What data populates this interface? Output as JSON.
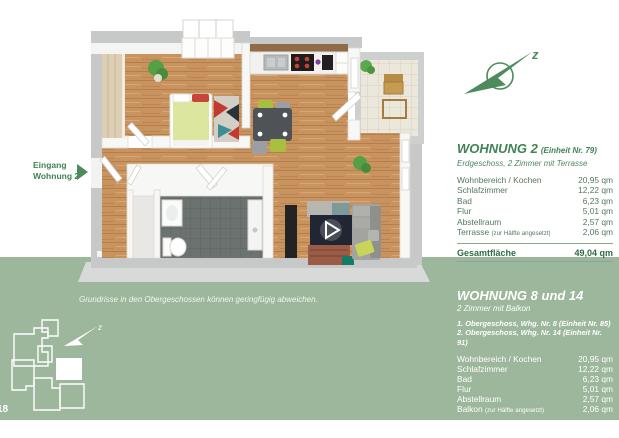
{
  "colors": {
    "brand_green": "#3f8354",
    "band_green": "#9cb79b",
    "row_green": "#53795f",
    "total_green": "#2e6a44"
  },
  "page_number": "18",
  "plan_annotations": {
    "entrance_label": "Eingang Wohnung 2",
    "compass_letter": "z"
  },
  "footer": {
    "disclaimer": "Grundrisse in den Obergeschossen können geringfügig abweichen."
  },
  "apartment_top": {
    "title": "WOHNUNG 2",
    "title_note": "(Einheit Nr. 79)",
    "subtitle": "Erdgeschoss, 2 Zimmer mit Terrasse",
    "rows": [
      {
        "label": "Wohnbereich / Kochen",
        "value": "20,95 qm"
      },
      {
        "label": "Schlafzimmer",
        "value": "12,22 qm"
      },
      {
        "label": "Bad",
        "value": "6,23 qm"
      },
      {
        "label": "Flur",
        "value": "5,01 qm"
      },
      {
        "label": "Abstellraum",
        "value": "2,57 qm"
      },
      {
        "label": "Terrasse",
        "note": "(zur Hälfte angesetzt)",
        "value": "2,06 qm"
      }
    ],
    "total_label": "Gesamtfläche",
    "total_value": "49,04 qm"
  },
  "apartment_bottom": {
    "title": "WOHNUNG 8 und 14",
    "subtitle": "2 Zimmer mit Balkon",
    "floor_notes": [
      "1. Obergeschoss, Whg. Nr. 8 (Einheit Nr. 85)",
      "2. Obergeschoss, Whg. Nr. 14 (Einheit Nr. 91)"
    ],
    "rows": [
      {
        "label": "Wohnbereich / Kochen",
        "value": "20,95 qm"
      },
      {
        "label": "Schlafzimmer",
        "value": "12,22 qm"
      },
      {
        "label": "Bad",
        "value": "6,23 qm"
      },
      {
        "label": "Flur",
        "value": "5,01 qm"
      },
      {
        "label": "Abstellraum",
        "value": "2,57 qm"
      },
      {
        "label": "Balkon",
        "note": "(zur Hälfte angesetzt)",
        "value": "2,06 qm"
      }
    ],
    "total_label": "Gesamtfläche",
    "total_value": "49,04 qm"
  }
}
